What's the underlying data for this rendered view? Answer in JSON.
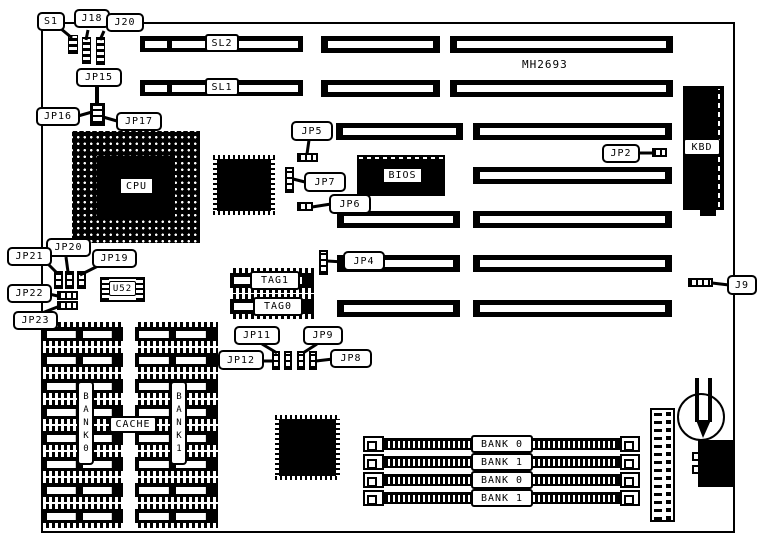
{
  "board": {
    "model": "MH2693"
  },
  "slots": {
    "sl2": "SL2",
    "sl1": "SL1"
  },
  "chips": {
    "cpu": "CPU",
    "bios": "BIOS",
    "kbd": "KBD",
    "u52": "U52",
    "tag1": "TAG1",
    "tag0": "TAG0"
  },
  "callouts": {
    "s1": "S1",
    "j18": "J18",
    "j20": "J20",
    "jp15": "JP15",
    "jp16": "JP16",
    "jp17": "JP17",
    "jp5": "JP5",
    "jp7": "JP7",
    "jp6": "JP6",
    "jp4": "JP4",
    "jp2": "JP2",
    "j9": "J9",
    "jp21": "JP21",
    "jp20": "JP20",
    "jp19": "JP19",
    "jp22": "JP22",
    "jp23": "JP23",
    "jp11": "JP11",
    "jp9": "JP9",
    "jp12": "JP12",
    "jp8": "JP8"
  },
  "cache": {
    "bank0": "BANK0",
    "bank1": "BANK1",
    "label": "CACHE"
  },
  "simm_banks": [
    "BANK 0",
    "BANK 1",
    "BANK 0",
    "BANK 1"
  ]
}
